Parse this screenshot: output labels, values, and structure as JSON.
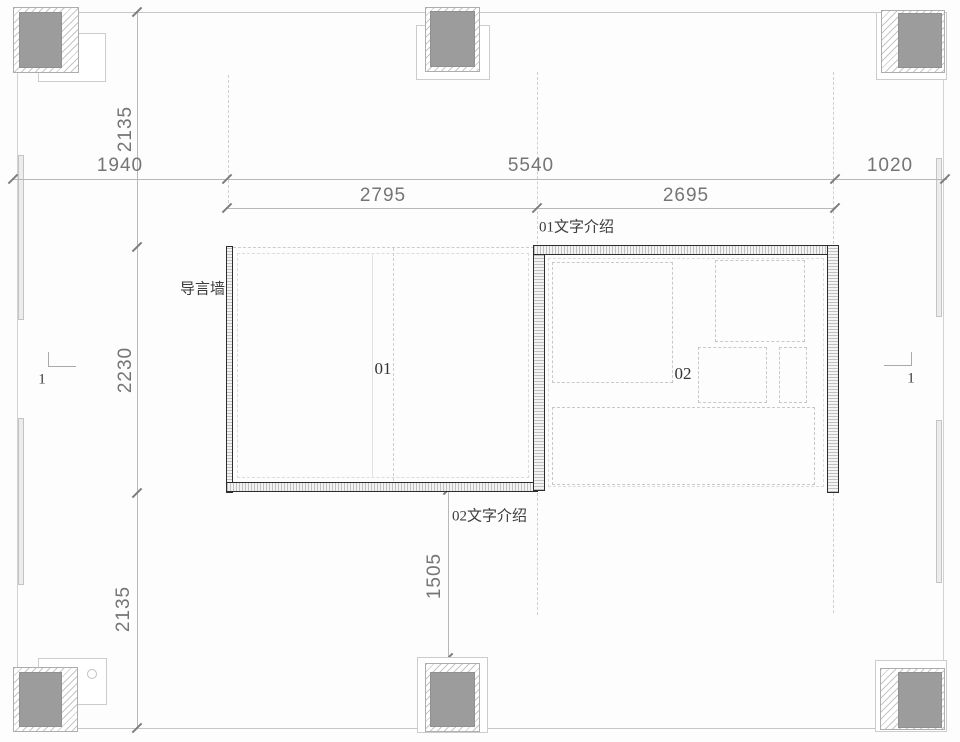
{
  "dimensions": {
    "top_left_vertical": "2135",
    "row1_left": "1940",
    "row1_center": "5540",
    "row1_right": "1020",
    "row2_left": "2795",
    "row2_right": "2695",
    "left_vertical": "2230",
    "bottom_center_vertical": "1505",
    "bottom_left_vertical": "2135"
  },
  "labels": {
    "intro_wall": "导言墙",
    "zone1_caption": "01文字介绍",
    "zone2_caption": "02文字介绍",
    "room1": "01",
    "room2": "02",
    "section_mark": "1"
  },
  "colors": {
    "wall_dark": "#2d2d2d",
    "column_fill": "#9c9c9c",
    "hatch_line": "#c5c5c5",
    "boundary_line": "#c6c6c6",
    "dimension_text": "#757575",
    "label_text": "#3c3c3c"
  }
}
